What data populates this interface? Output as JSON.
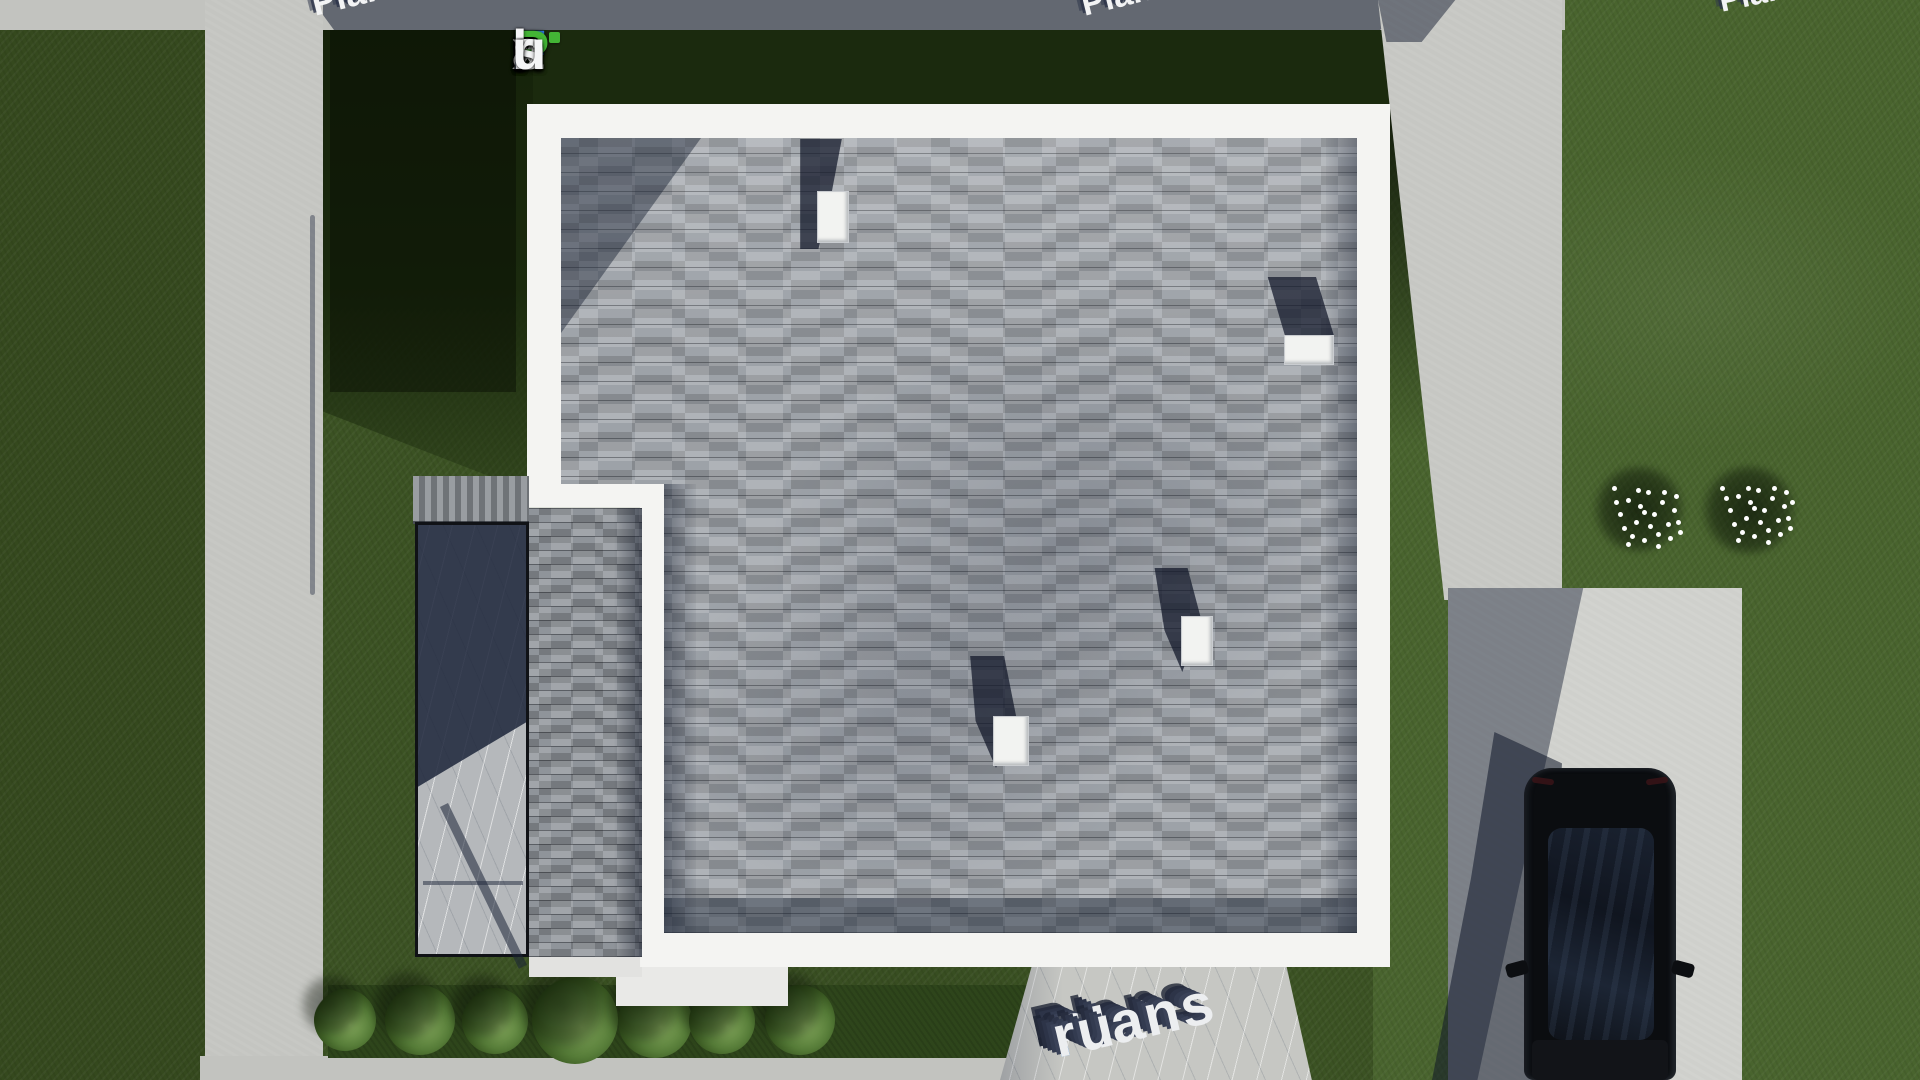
{
  "logo": {
    "full_text": "FixPlans.ru",
    "chars": [
      {
        "c": "F"
      },
      {
        "c": "i"
      },
      {
        "c": "x"
      },
      {
        "c": "P"
      },
      {
        "c": "l"
      },
      {
        "c": "a"
      },
      {
        "c": "n"
      },
      {
        "c": "s"
      },
      {
        "c": "."
      },
      {
        "c": "r"
      },
      {
        "c": "u"
      }
    ]
  },
  "watermarks": {
    "bottom": {
      "part1": "Plans",
      "dot": ".",
      "part2": "ru"
    },
    "fragments": [
      {
        "text": "Plans.ru"
      },
      {
        "text": "Plans.ru"
      },
      {
        "text": "Plans.ru"
      }
    ]
  },
  "colors": {
    "logo_blue": "#2e7ce2",
    "logo_green": "#43b535",
    "logo_white": "#f4f5f6",
    "watermark_dot_blue": "#2a7fd4",
    "grass_left": "#35491e",
    "grass_mid": "#3b5223",
    "grass_right": "#49642e",
    "grass_shadow": "#1b2a0e",
    "concrete_path": "#c4c5c1",
    "driveway": "#cfd0cc",
    "roof_eave_white": "#f4f4f2",
    "shingle_gray": "#9da2a8",
    "paver_gray": "#8f949a",
    "marble": "#c6c7c3",
    "shadow_navy": "#1c2438",
    "car_black": "#0b0d10",
    "bush_green": "#5c8140",
    "flower_white": "#ffffff"
  }
}
